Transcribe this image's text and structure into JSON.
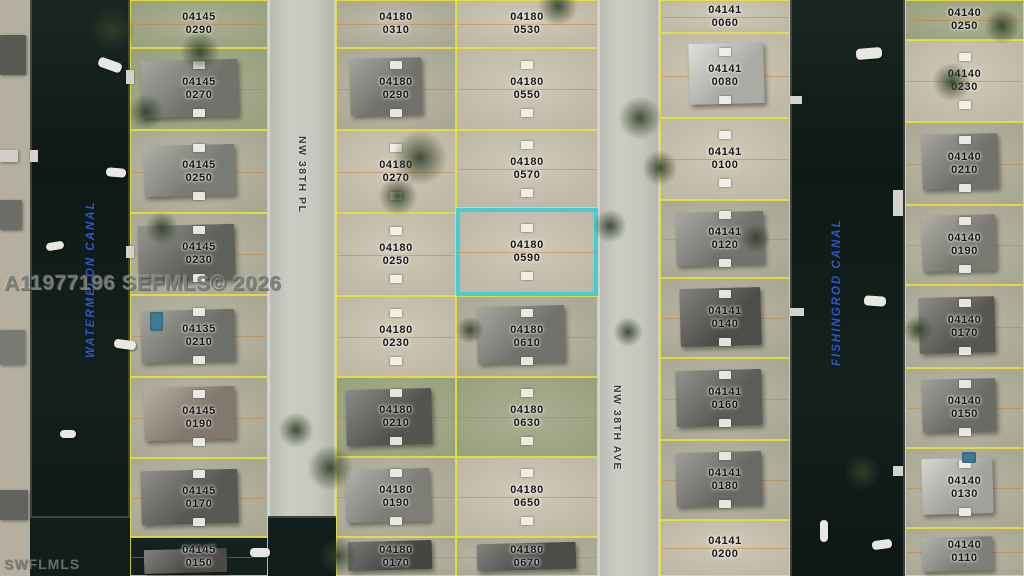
{
  "map": {
    "watermark_center": "A11977196 SEFMLS© 2026",
    "watermark_corner": "SWFLMLS",
    "colors": {
      "highlight": "#46ccd4",
      "parcel_line": "#e9e436",
      "lot_line": "#c77f35",
      "canal_label": "#2b59c8",
      "water": "#111d1a"
    },
    "canals": [
      {
        "name": "WATERMELON CANAL",
        "x": 30,
        "w": 100,
        "label": {
          "x": 84,
          "y": 188,
          "h": 182
        }
      },
      {
        "name": "FISHINGROD CANAL",
        "x": 790,
        "w": 115,
        "label": {
          "x": 830,
          "y": 226,
          "h": 140
        }
      }
    ],
    "streets": [
      {
        "name": "NW 38TH PL",
        "x": 268,
        "w": 68,
        "label": {
          "x": 295,
          "y": 136,
          "h": 72
        }
      },
      {
        "name": "NW 38TH AVE",
        "x": 598,
        "w": 62,
        "label": {
          "x": 610,
          "y": 384,
          "h": 88
        }
      }
    ],
    "columns": [
      {
        "id": "col-04145",
        "x": 130,
        "w": 138,
        "parcels": [
          {
            "book": "04145",
            "lot": "0290",
            "y": 0,
            "h": 48,
            "terrain": "grass"
          },
          {
            "book": "04145",
            "lot": "0270",
            "y": 48,
            "h": 82,
            "terrain": "grass",
            "house": {
              "l": 8,
              "t": 15,
              "w": 70,
              "h": 70,
              "c": "#8e8e88"
            }
          },
          {
            "book": "04145",
            "lot": "0250",
            "y": 130,
            "h": 83,
            "terrain": "mixed",
            "house": {
              "l": 10,
              "t": 18,
              "w": 66,
              "h": 62,
              "c": "#9a9a92"
            }
          },
          {
            "book": "04145",
            "lot": "0230",
            "y": 213,
            "h": 82,
            "terrain": "mixed",
            "house": {
              "l": 6,
              "t": 15,
              "w": 70,
              "h": 68,
              "c": "#787872"
            }
          },
          {
            "book": "04135",
            "lot": "0210",
            "y": 295,
            "h": 82,
            "terrain": "mixed",
            "house": {
              "l": 8,
              "t": 18,
              "w": 68,
              "h": 64,
              "c": "#8b8b84"
            }
          },
          {
            "book": "04145",
            "lot": "0190",
            "y": 377,
            "h": 81,
            "terrain": "mixed",
            "house": {
              "l": 10,
              "t": 12,
              "w": 66,
              "h": 66,
              "c": "#a29688"
            }
          },
          {
            "book": "04145",
            "lot": "0170",
            "y": 458,
            "h": 79,
            "terrain": "mixed",
            "house": {
              "l": 8,
              "t": 15,
              "w": 70,
              "h": 68,
              "c": "#6f6f69"
            }
          },
          {
            "book": "04145",
            "lot": "0150",
            "y": 537,
            "h": 39,
            "terrain": "water",
            "house": {
              "l": 10,
              "t": 30,
              "w": 60,
              "h": 62,
              "c": "#5d5d58"
            }
          }
        ]
      },
      {
        "id": "col-04180-west",
        "x": 336,
        "w": 120,
        "parcels": [
          {
            "book": "04180",
            "lot": "0310",
            "y": 0,
            "h": 48,
            "terrain": "mixed"
          },
          {
            "book": "04180",
            "lot": "0290",
            "y": 48,
            "h": 82,
            "terrain": "mixed",
            "house": {
              "l": 12,
              "t": 12,
              "w": 60,
              "h": 70,
              "c": "#8d8d86"
            }
          },
          {
            "book": "04180",
            "lot": "0270",
            "y": 130,
            "h": 83,
            "terrain": "sand"
          },
          {
            "book": "04180",
            "lot": "0250",
            "y": 213,
            "h": 83,
            "terrain": "sand"
          },
          {
            "book": "04180",
            "lot": "0230",
            "y": 296,
            "h": 81,
            "terrain": "sand"
          },
          {
            "book": "04180",
            "lot": "0210",
            "y": 377,
            "h": 80,
            "terrain": "grass",
            "house": {
              "l": 8,
              "t": 15,
              "w": 72,
              "h": 70,
              "c": "#6a6a64"
            }
          },
          {
            "book": "04180",
            "lot": "0190",
            "y": 457,
            "h": 80,
            "terrain": "mixed",
            "house": {
              "l": 8,
              "t": 15,
              "w": 70,
              "h": 66,
              "c": "#9d9d95"
            }
          },
          {
            "book": "04180",
            "lot": "0170",
            "y": 537,
            "h": 39,
            "terrain": "mixed",
            "house": {
              "l": 10,
              "t": 10,
              "w": 70,
              "h": 75,
              "c": "#565651"
            }
          }
        ]
      },
      {
        "id": "col-04180-east",
        "x": 456,
        "w": 142,
        "parcels": [
          {
            "book": "04180",
            "lot": "0530",
            "y": 0,
            "h": 48,
            "terrain": "sand"
          },
          {
            "book": "04180",
            "lot": "0550",
            "y": 48,
            "h": 82,
            "terrain": "sand"
          },
          {
            "book": "04180",
            "lot": "0570",
            "y": 130,
            "h": 78,
            "terrain": "sand"
          },
          {
            "book": "04180",
            "lot": "0590",
            "y": 208,
            "h": 88,
            "terrain": "sand",
            "highlighted": true
          },
          {
            "book": "04180",
            "lot": "0610",
            "y": 296,
            "h": 81,
            "terrain": "mixed",
            "house": {
              "l": 15,
              "t": 12,
              "w": 62,
              "h": 70,
              "c": "#8f8f88"
            }
          },
          {
            "book": "04180",
            "lot": "0630",
            "y": 377,
            "h": 80,
            "terrain": "grass"
          },
          {
            "book": "04180",
            "lot": "0650",
            "y": 457,
            "h": 80,
            "terrain": "sand"
          },
          {
            "book": "04180",
            "lot": "0670",
            "y": 537,
            "h": 39,
            "terrain": "mixed",
            "house": {
              "l": 15,
              "t": 15,
              "w": 70,
              "h": 70,
              "c": "#5e5e59"
            }
          }
        ]
      },
      {
        "id": "col-04141",
        "x": 660,
        "w": 130,
        "parcels": [
          {
            "book": "04141",
            "lot": "0060",
            "y": 0,
            "h": 33,
            "terrain": "sand"
          },
          {
            "book": "04141",
            "lot": "0080",
            "y": 33,
            "h": 85,
            "terrain": "sand",
            "house": {
              "l": 22,
              "t": 12,
              "w": 58,
              "h": 72,
              "c": "#d6d6cf"
            }
          },
          {
            "book": "04141",
            "lot": "0100",
            "y": 118,
            "h": 82,
            "terrain": "sand"
          },
          {
            "book": "04141",
            "lot": "0120",
            "y": 200,
            "h": 78,
            "terrain": "mixed",
            "house": {
              "l": 12,
              "t": 15,
              "w": 68,
              "h": 68,
              "c": "#90908a"
            }
          },
          {
            "book": "04141",
            "lot": "0140",
            "y": 278,
            "h": 80,
            "terrain": "mixed",
            "house": {
              "l": 15,
              "t": 12,
              "w": 62,
              "h": 72,
              "c": "#60605b"
            }
          },
          {
            "book": "04141",
            "lot": "0160",
            "y": 358,
            "h": 82,
            "terrain": "mixed",
            "house": {
              "l": 12,
              "t": 15,
              "w": 66,
              "h": 68,
              "c": "#74746e"
            }
          },
          {
            "book": "04141",
            "lot": "0180",
            "y": 440,
            "h": 80,
            "terrain": "mixed",
            "house": {
              "l": 12,
              "t": 15,
              "w": 66,
              "h": 68,
              "c": "#84847d"
            }
          },
          {
            "book": "04141",
            "lot": "0200",
            "y": 520,
            "h": 56,
            "terrain": "sand"
          }
        ]
      },
      {
        "id": "col-04140",
        "x": 905,
        "w": 119,
        "parcels": [
          {
            "book": "04140",
            "lot": "0250",
            "y": 0,
            "h": 40,
            "terrain": "grass"
          },
          {
            "book": "04140",
            "lot": "0230",
            "y": 40,
            "h": 82,
            "terrain": "sand"
          },
          {
            "book": "04140",
            "lot": "0210",
            "y": 122,
            "h": 83,
            "terrain": "mixed",
            "house": {
              "l": 14,
              "t": 15,
              "w": 64,
              "h": 66,
              "c": "#8d8d86"
            }
          },
          {
            "book": "04140",
            "lot": "0190",
            "y": 205,
            "h": 80,
            "terrain": "mixed",
            "house": {
              "l": 14,
              "t": 12,
              "w": 62,
              "h": 70,
              "c": "#99998f"
            }
          },
          {
            "book": "04140",
            "lot": "0170",
            "y": 285,
            "h": 83,
            "terrain": "mixed",
            "house": {
              "l": 12,
              "t": 14,
              "w": 64,
              "h": 68,
              "c": "#6d6d66"
            }
          },
          {
            "book": "04140",
            "lot": "0150",
            "y": 368,
            "h": 80,
            "terrain": "mixed",
            "house": {
              "l": 14,
              "t": 14,
              "w": 62,
              "h": 66,
              "c": "#86867f"
            }
          },
          {
            "book": "04140",
            "lot": "0130",
            "y": 448,
            "h": 80,
            "terrain": "mixed",
            "house": {
              "l": 14,
              "t": 12,
              "w": 60,
              "h": 70,
              "c": "#cbcbc4"
            }
          },
          {
            "book": "04140",
            "lot": "0110",
            "y": 528,
            "h": 48,
            "terrain": "mixed",
            "house": {
              "l": 14,
              "t": 18,
              "w": 60,
              "h": 70,
              "c": "#9e9e97"
            }
          }
        ]
      }
    ]
  }
}
